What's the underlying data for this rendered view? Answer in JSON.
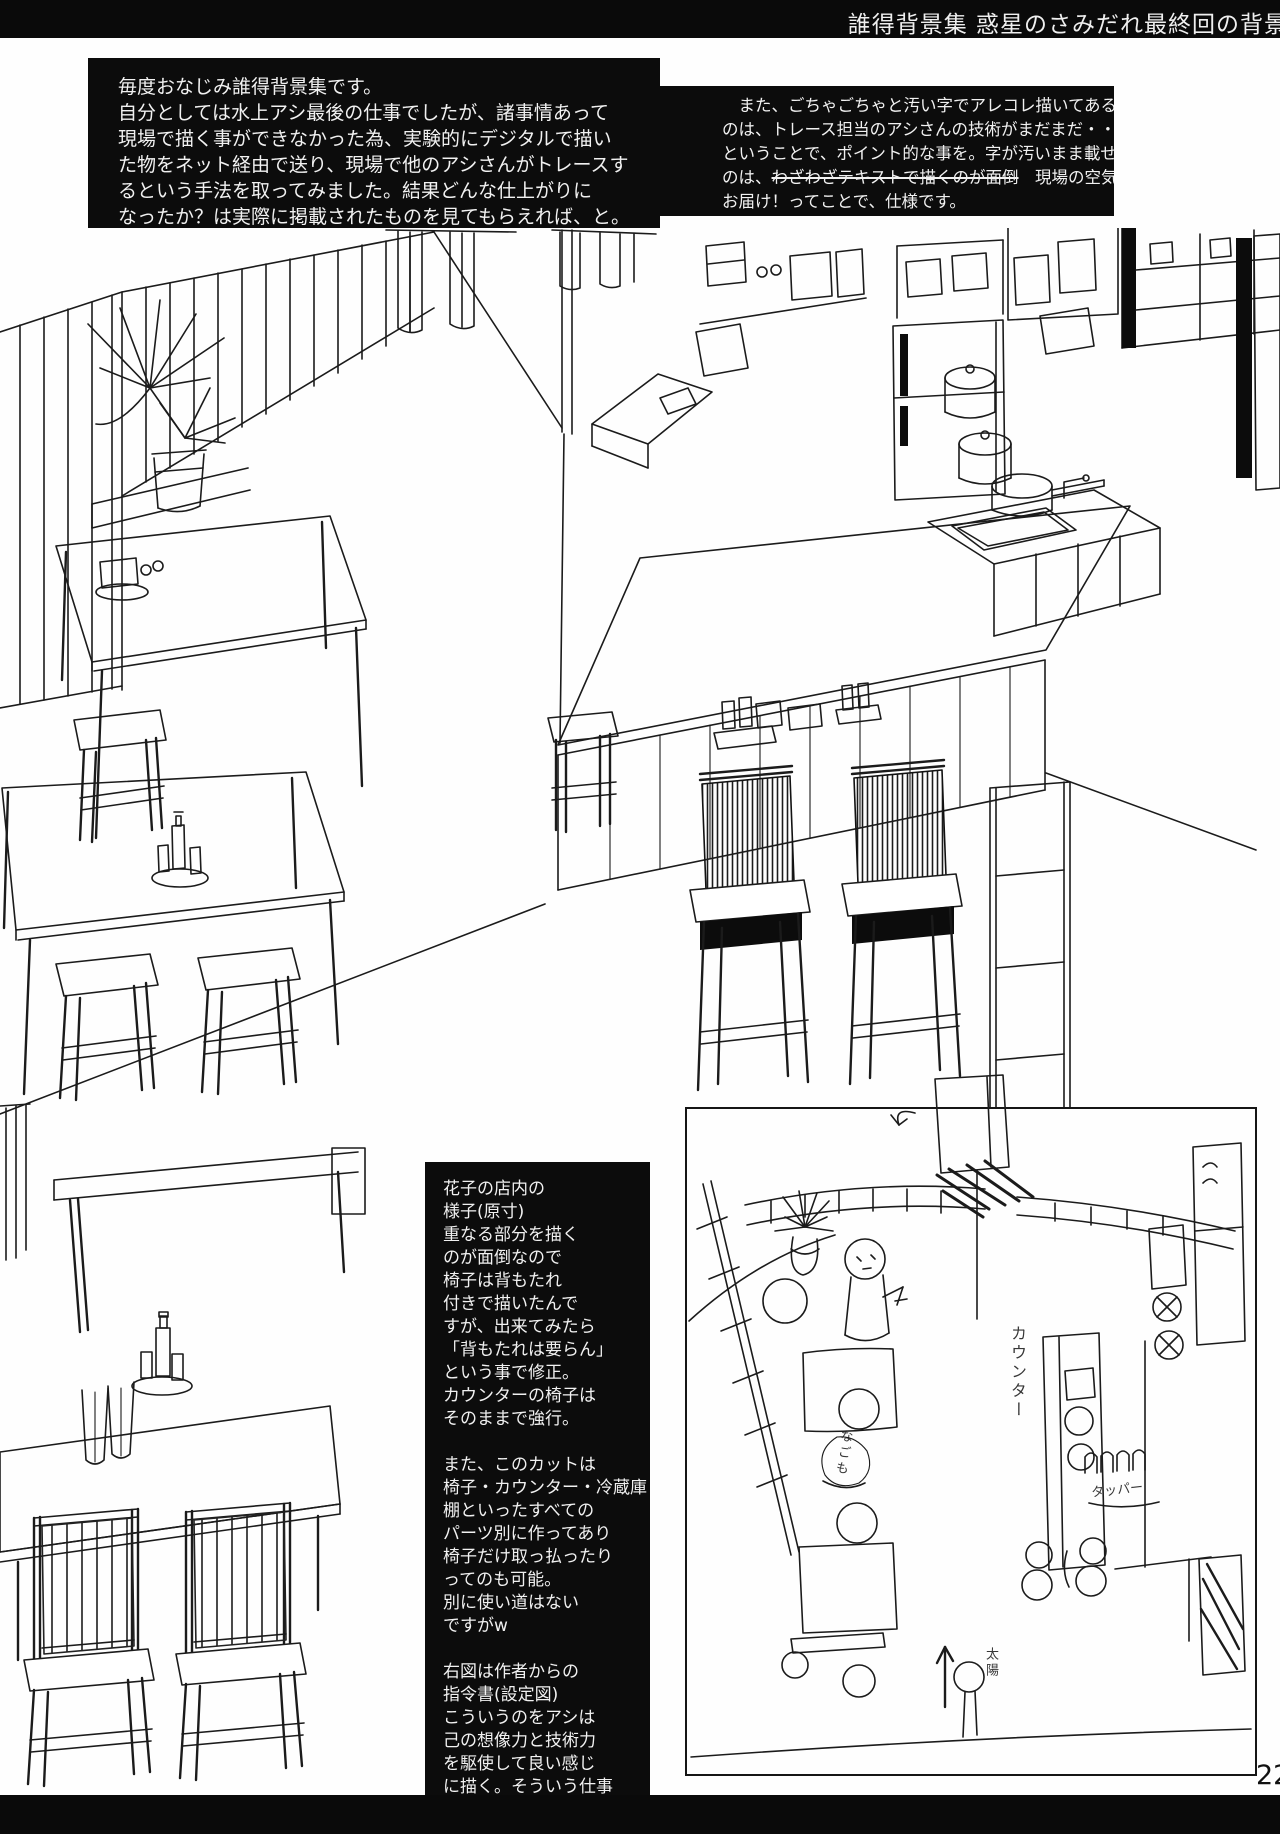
{
  "page": {
    "header_title": "誰得背景集 惑星のさみだれ最終回の背景",
    "page_number": "22"
  },
  "intro_left": {
    "lines": [
      "毎度おなじみ誰得背景集です。",
      "自分としては水上アシ最後の仕事でしたが、諸事情あって",
      "現場で描く事ができなかった為、実験的にデジタルで描い",
      "た物をネット経由で送り、現場で他のアシさんがトレースす",
      "るという手法を取ってみました。結果どんな仕上がりに",
      "なったか？は実際に掲載されたものを見てもらえれば、と。"
    ]
  },
  "intro_right": {
    "line1": "　また、ごちゃごちゃと汚い字でアレコレ描いてある",
    "line2": "のは、トレース担当のアシさんの技術がまだまだ・・・",
    "line3": "ということで、ポイント的な事を。字が汚いまま載せる",
    "line4_pre": "のは、",
    "line4_strike": "わざわざテキストで描くのが面倒",
    "line4_post": "　現場の空気を",
    "line5": "お届け！ってことで、仕様です。"
  },
  "notes": {
    "lines": [
      "花子の店内の",
      "様子(原寸)",
      "重なる部分を描く",
      "のが面倒なので",
      "椅子は背もたれ",
      "付きで描いたんで",
      "すが、出来てみたら",
      "「背もたれは要らん」",
      "という事で修正。",
      "カウンターの椅子は",
      "そのままで強行。",
      "",
      "また、このカットは",
      "椅子・カウンター・冷蔵庫",
      "棚といったすべての",
      "パーツ別に作ってあり",
      "椅子だけ取っ払ったり",
      "ってのも可能。",
      "別に使い道はない",
      "ですがw",
      "",
      "右図は作者からの",
      "指令書(設定図)",
      "こういうのをアシは",
      "己の想像力と技術力",
      "を駆使して良い感じ",
      "に描く。そういう仕事",
      "なのです。多分。"
    ]
  },
  "sketch": {
    "labels": {
      "counter": "カウンター",
      "container": "タッパー",
      "sun": "太陽",
      "nagomo": "なごも"
    }
  }
}
